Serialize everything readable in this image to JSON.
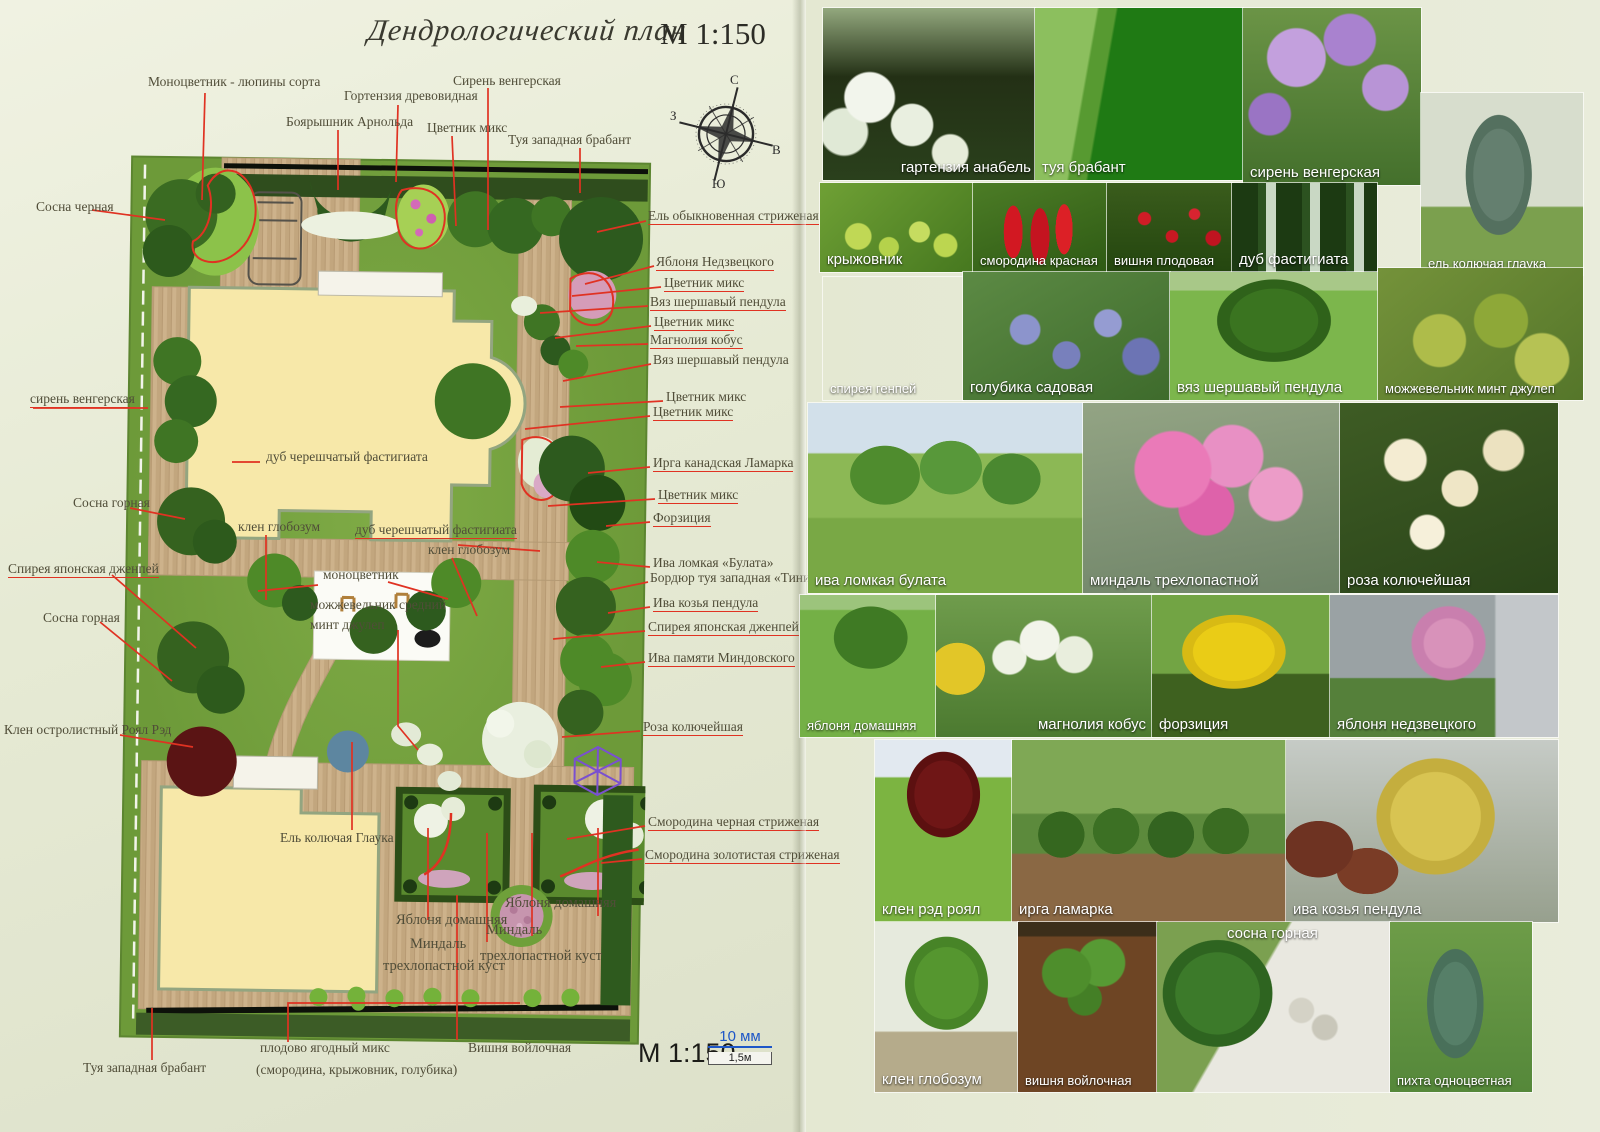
{
  "title": {
    "script": "Дендрологический план",
    "scale": "М 1:150"
  },
  "compass": {
    "north": "С",
    "east": "В",
    "south": "Ю",
    "west": "З"
  },
  "plan": {
    "labels": [
      {
        "text": "Моноцветник - люпины сорта"
      },
      {
        "text": "Боярышник Арнольда"
      },
      {
        "text": "Гортензия древовидная"
      },
      {
        "text": "Цветник микс"
      },
      {
        "text": "Сирень венгерская"
      },
      {
        "text": "Туя западная брабант"
      },
      {
        "text": "Сосна черная"
      },
      {
        "text": "Ель обыкновенная стриженая"
      },
      {
        "text": "Яблоня Недзвецкого"
      },
      {
        "text": "Цветник микс"
      },
      {
        "text": "Вяз шершавый пендула"
      },
      {
        "text": "Цветник микс"
      },
      {
        "text": "Магнолия кобус"
      },
      {
        "text": "Вяз шершавый пендула"
      },
      {
        "text": "Цветник микс"
      },
      {
        "text": "Цветник микс"
      },
      {
        "text": "сирень венгерская"
      },
      {
        "text": "дуб черешчатый фастигиата"
      },
      {
        "text": "Ирга канадская Ламарка"
      },
      {
        "text": "Цветник микс"
      },
      {
        "text": "Сосна горная"
      },
      {
        "text": "клен глобозум"
      },
      {
        "text": "дуб черешчатый фастигиата"
      },
      {
        "text": "Форзиция"
      },
      {
        "text": "клен глобозум"
      },
      {
        "text": "Ива ломкая «Булата»"
      },
      {
        "text": "Бордюр туя западная «Тини тим»"
      },
      {
        "text": "Спирея японская дженпей"
      },
      {
        "text": "моноцветник"
      },
      {
        "text": "можжевельник средний"
      },
      {
        "text": "минт джулеп"
      },
      {
        "text": "Ива козья пендула"
      },
      {
        "text": "Сосна горная"
      },
      {
        "text": "Спирея японская дженпей"
      },
      {
        "text": "Ива памяти Миндовского"
      },
      {
        "text": "Клен остролистный Роял Рэд"
      },
      {
        "text": "Роза колючейшая"
      },
      {
        "text": "Ель колючая Глаука"
      },
      {
        "text": "Смородина черная стриженая"
      },
      {
        "text": "Смородина золотистая стриженая"
      },
      {
        "text": "Яблоня домашняя"
      },
      {
        "text": "Миндаль"
      },
      {
        "text": "трехлопастной куст"
      },
      {
        "text": "Яблоня домашняя"
      },
      {
        "text": "Миндаль"
      },
      {
        "text": "трехлопастной куст"
      },
      {
        "text": "Туя западная брабант"
      },
      {
        "text": "плодово ягодный микс"
      },
      {
        "text": "(смородина, крыжовник, голубика)"
      },
      {
        "text": "Вишня войлочная"
      }
    ]
  },
  "footer": {
    "scale": "М 1:150",
    "bar_mm": "10 мм",
    "bar_m": "1,5м"
  },
  "photos": [
    {
      "caption": "гартензия анабель"
    },
    {
      "caption": "туя брабант"
    },
    {
      "caption": "сирень венгерская"
    },
    {
      "caption": "ель колючая глаука"
    },
    {
      "caption": "крыжовник"
    },
    {
      "caption": "смородина красная"
    },
    {
      "caption": "вишня плодовая"
    },
    {
      "caption": "дуб фастигиата"
    },
    {
      "caption": "спирея генпей"
    },
    {
      "caption": "голубика садовая"
    },
    {
      "caption": "вяз шершавый пендула"
    },
    {
      "caption": "можжевельник минт джулеп"
    },
    {
      "caption": "ива ломкая булата"
    },
    {
      "caption": "миндаль трехлопастной"
    },
    {
      "caption": "роза колючейшая"
    },
    {
      "caption": "яблоня домашняя"
    },
    {
      "caption": "магнолия кобус"
    },
    {
      "caption": "форзиция"
    },
    {
      "caption": "яблоня недзвецкого"
    },
    {
      "caption": "клен рэд роял"
    },
    {
      "caption": "ирга ламарка"
    },
    {
      "caption": "ива козья пендула"
    },
    {
      "caption": "клен глобозум"
    },
    {
      "caption": "вишня войлочная"
    },
    {
      "caption": "сосна горная"
    },
    {
      "caption": "пихта одноцветная"
    }
  ]
}
